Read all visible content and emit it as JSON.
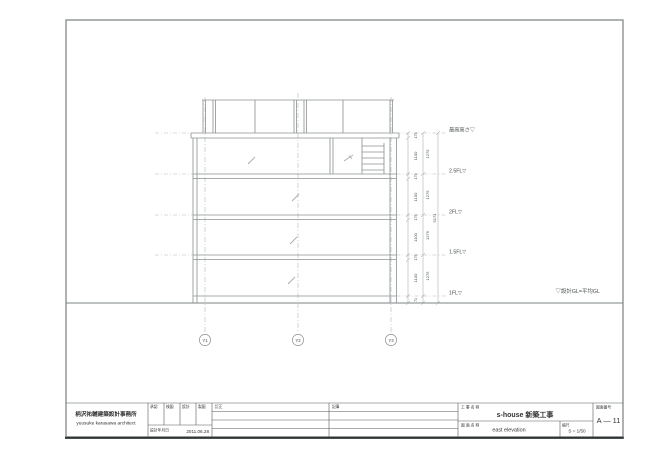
{
  "drawing": {
    "gl_label": "▽設計GL=平均GL",
    "levels": [
      {
        "label": "最高高さ▽"
      },
      {
        "label": "2.5FL▽"
      },
      {
        "label": "2FL▽"
      },
      {
        "label": "1.5FL▽"
      },
      {
        "label": "1FL▽"
      }
    ],
    "grid_labels": [
      "Y1",
      "Y2",
      "Y3"
    ],
    "dims_floor": [
      "1275",
      "1275",
      "1275",
      "1275"
    ],
    "dims_inner": [
      "175",
      "1100",
      "175",
      "1100",
      "175",
      "1100",
      "175",
      "1100"
    ],
    "dim_gl": "71",
    "dim_total": "5171"
  },
  "titleblock": {
    "architect_jp": "柄沢祐輔建築設計事務所",
    "architect_en": "yuusuke karasawa architect",
    "sign_cols": [
      "承認",
      "検図",
      "設計",
      "製図"
    ],
    "date_label": "設計年月日",
    "date_value": "2011.06.28",
    "rev_col_1": "訂正",
    "rev_col_2": "記事",
    "project_label": "工 事 名 称",
    "project_value": "s-house 新築工事",
    "drawing_label": "図 面 名 称",
    "drawing_value": "east elevation",
    "scale_label": "縮尺",
    "scale_value": "S = 1/50",
    "number_label": "図面番号",
    "number_value": "A — 11"
  }
}
